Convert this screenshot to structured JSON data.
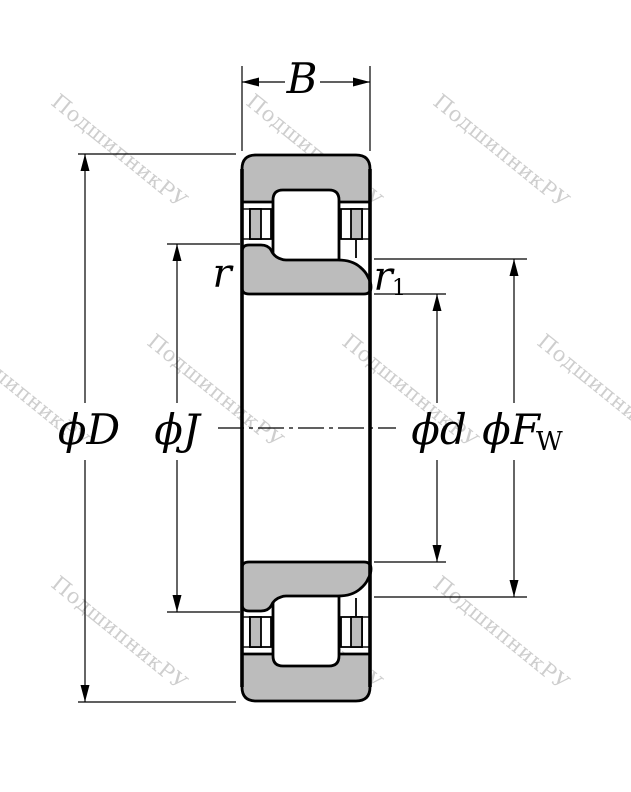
{
  "diagram": {
    "type": "cylindrical-roller-bearing-cross-section",
    "background": "#ffffff",
    "line_color": "#000000",
    "ring_fill": "#bcbcbc",
    "watermark": {
      "text": "ПодшипникРУ",
      "color": "#c6c6c6"
    },
    "labels": {
      "width": "B",
      "outer_diameter": "ϕD",
      "inner_rib_diameter": "ϕJ",
      "bore_diameter": "ϕd",
      "raceway_diameter": "ϕF",
      "raceway_diameter_sub": "W",
      "chamfer_outer": "r",
      "chamfer_inner": "r",
      "chamfer_inner_sub": "1"
    }
  }
}
